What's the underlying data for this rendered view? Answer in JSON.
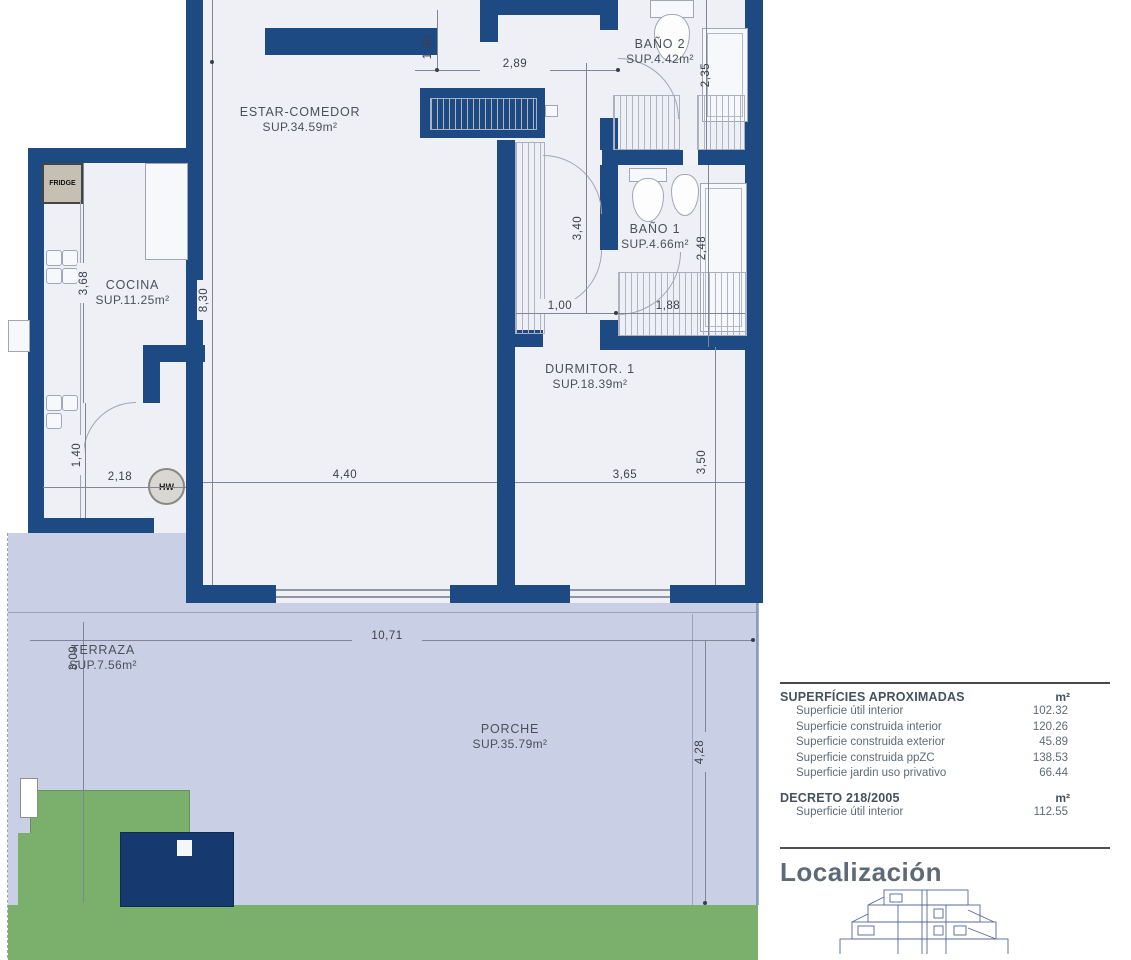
{
  "plan": {
    "rooms": {
      "bano2": {
        "name": "BAÑO 2",
        "area": "SUP.4.42m²"
      },
      "estar": {
        "name": "ESTAR-COMEDOR",
        "area": "SUP.34.59m²"
      },
      "cocina": {
        "name": "COCINA",
        "area": "SUP.11.25m²"
      },
      "bano1": {
        "name": "BAÑO 1",
        "area": "SUP.4.66m²"
      },
      "dorm1": {
        "name": "DURMITOR. 1",
        "area": "SUP.18.39m²"
      },
      "terraza": {
        "name": "TERRAZA",
        "area": "SUP.7.56m²"
      },
      "porche": {
        "name": "PORCHE",
        "area": "SUP.35.79m²"
      }
    },
    "dims": {
      "top_100": "1,00",
      "top_289": "2,89",
      "right_235": "2,35",
      "mid_340": "3,40",
      "right_248": "2,48",
      "kitchen_368": "3,68",
      "living_830": "8,30",
      "hall_100": "1,00",
      "closet_188": "1,88",
      "util_140": "1,40",
      "util_218": "2,18",
      "living_440": "4,40",
      "dorm_365": "3,65",
      "right_350": "3,50",
      "terraza_309": "3,09",
      "porche_1071": "10,71",
      "porche_428": "4,28"
    },
    "annotations": {
      "fridge": "FRIDGE",
      "heater": "HW"
    }
  },
  "panel": {
    "superficies": {
      "title": "SUPERFÍCIES APROXIMADAS",
      "unit": "m²",
      "rows": [
        {
          "label": "Superficie útil interior",
          "value": "102.32"
        },
        {
          "label": "Superficie construida interior",
          "value": "120.26"
        },
        {
          "label": "Superficie construida exterior",
          "value": "45.89"
        },
        {
          "label": "Superficie construida ppZC",
          "value": "138.53"
        },
        {
          "label": "Superficie jardin uso privativo",
          "value": "66.44"
        }
      ]
    },
    "decreto": {
      "title": "DECRETO 218/2005",
      "unit": "m²",
      "rows": [
        {
          "label": "Superficie útil interior",
          "value": "112.55"
        }
      ]
    },
    "localizacion": {
      "title": "Localización"
    }
  },
  "colors": {
    "wall": "#1d4a82",
    "floor": "#eef0f6",
    "porch_terrace": "#c9cfe5",
    "garden": "#7ab06b",
    "planter": "#16396f",
    "fridge_box": "#c6c0b4"
  }
}
